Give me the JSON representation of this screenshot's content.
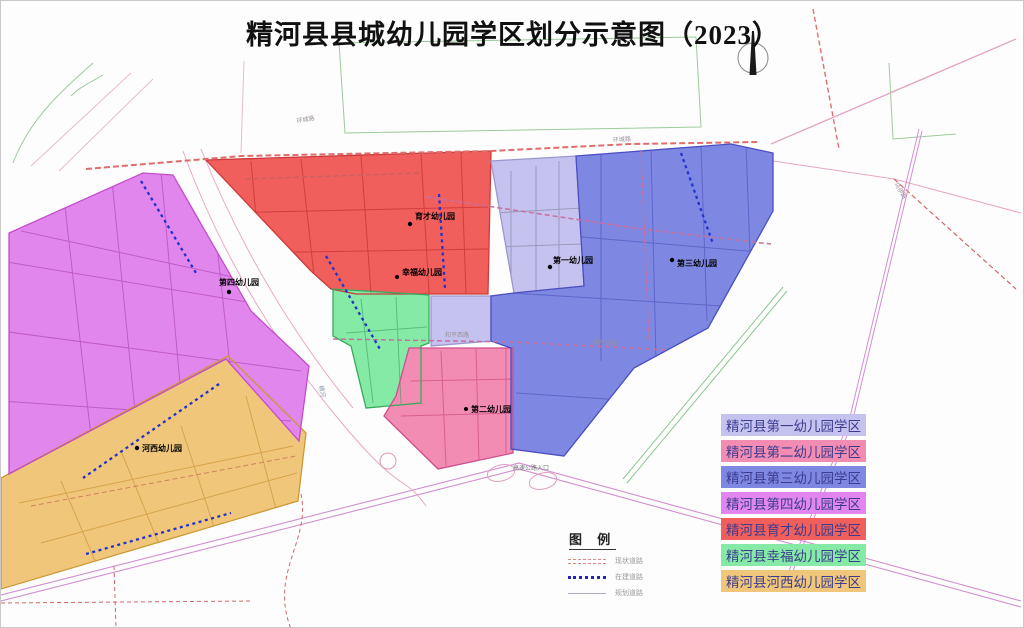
{
  "title": "精河县县城幼儿园学区划分示意图（2023）",
  "districts": [
    {
      "name": "精河县第一幼儿园学区",
      "color": "#c6c2ef"
    },
    {
      "name": "精河县第二幼儿园学区",
      "color": "#f38cb2"
    },
    {
      "name": "精河县第三幼儿园学区",
      "color": "#7e88e2"
    },
    {
      "name": "精河县第四幼儿园学区",
      "color": "#e186ec"
    },
    {
      "name": "精河县育才幼儿园学区",
      "color": "#f15f5c"
    },
    {
      "name": "精河县幸福幼儿园学区",
      "color": "#85eaa6"
    },
    {
      "name": "精河县河西幼儿园学区",
      "color": "#f0c67a"
    }
  ],
  "legend_box": {
    "title": "图 例",
    "items": [
      {
        "label": "现状道路",
        "color": "#e08888"
      },
      {
        "label": "在建道路",
        "color": "#2424bb"
      },
      {
        "label": "规划道路",
        "color": "#b0a8c0"
      }
    ]
  },
  "kindergartens": [
    {
      "name": "育才幼儿园"
    },
    {
      "name": "幸福幼儿园"
    },
    {
      "name": "第一幼儿园"
    },
    {
      "name": "第三幼儿园"
    },
    {
      "name": "第四幼儿园"
    },
    {
      "name": "第二幼儿园"
    },
    {
      "name": "河西幼儿园"
    }
  ],
  "road_labels": [
    {
      "text": "环城路"
    },
    {
      "text": "环城路"
    },
    {
      "text": "和平西路"
    },
    {
      "text": "和平支路"
    },
    {
      "text": "高速公路入口"
    },
    {
      "text": "乌伊路"
    },
    {
      "text": "精河"
    }
  ]
}
